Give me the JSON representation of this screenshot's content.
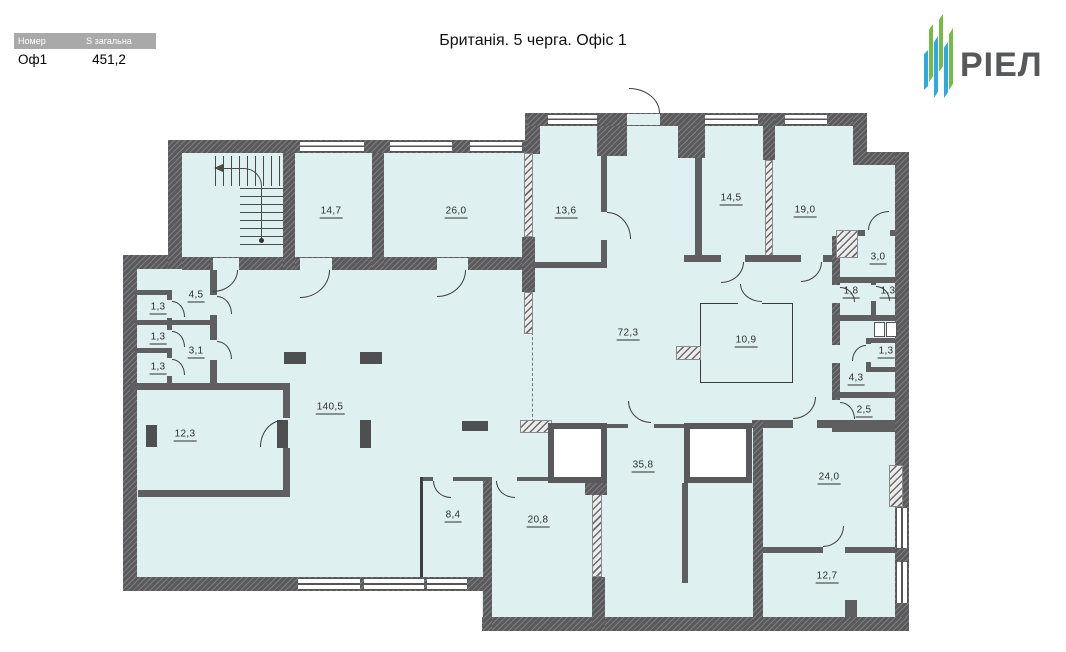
{
  "header": {
    "table": {
      "col_number_label": "Номер",
      "col_area_label": "S загальна",
      "unit_number": "Оф1",
      "total_area": "451,2"
    },
    "title": "Британія. 5 черга. Офіс 1",
    "logo_text": "РІЕЛ"
  },
  "rooms": [
    {
      "id": "room-1",
      "area": "14,7"
    },
    {
      "id": "room-2",
      "area": "26,0"
    },
    {
      "id": "room-3",
      "area": "13,6"
    },
    {
      "id": "room-4",
      "area": "14,5"
    },
    {
      "id": "room-5",
      "area": "19,0"
    },
    {
      "id": "room-6",
      "area": "3,0"
    },
    {
      "id": "room-7",
      "area": "4,5"
    },
    {
      "id": "room-8",
      "area": "1,3"
    },
    {
      "id": "room-9",
      "area": "1,3"
    },
    {
      "id": "room-10",
      "area": "3,1"
    },
    {
      "id": "room-11",
      "area": "1,3"
    },
    {
      "id": "room-12",
      "area": "1,8"
    },
    {
      "id": "room-13",
      "area": "1,3"
    },
    {
      "id": "room-14",
      "area": "72,3"
    },
    {
      "id": "room-15",
      "area": "10,9"
    },
    {
      "id": "room-16",
      "area": "1,3"
    },
    {
      "id": "room-17",
      "area": "4,3"
    },
    {
      "id": "room-18",
      "area": "2,5"
    },
    {
      "id": "room-19",
      "area": "140,5"
    },
    {
      "id": "room-20",
      "area": "12,3"
    },
    {
      "id": "room-21",
      "area": "35,8"
    },
    {
      "id": "room-22",
      "area": "24,0"
    },
    {
      "id": "room-23",
      "area": "8,4"
    },
    {
      "id": "room-24",
      "area": "20,8"
    },
    {
      "id": "room-25",
      "area": "12,7"
    }
  ],
  "colors": {
    "floor_fill": "#def0f0",
    "wall": "#5a5a5c",
    "logo_green": "#76bc43",
    "logo_blue": "#2caae1",
    "table_header_bg": "#a9a9a9"
  }
}
